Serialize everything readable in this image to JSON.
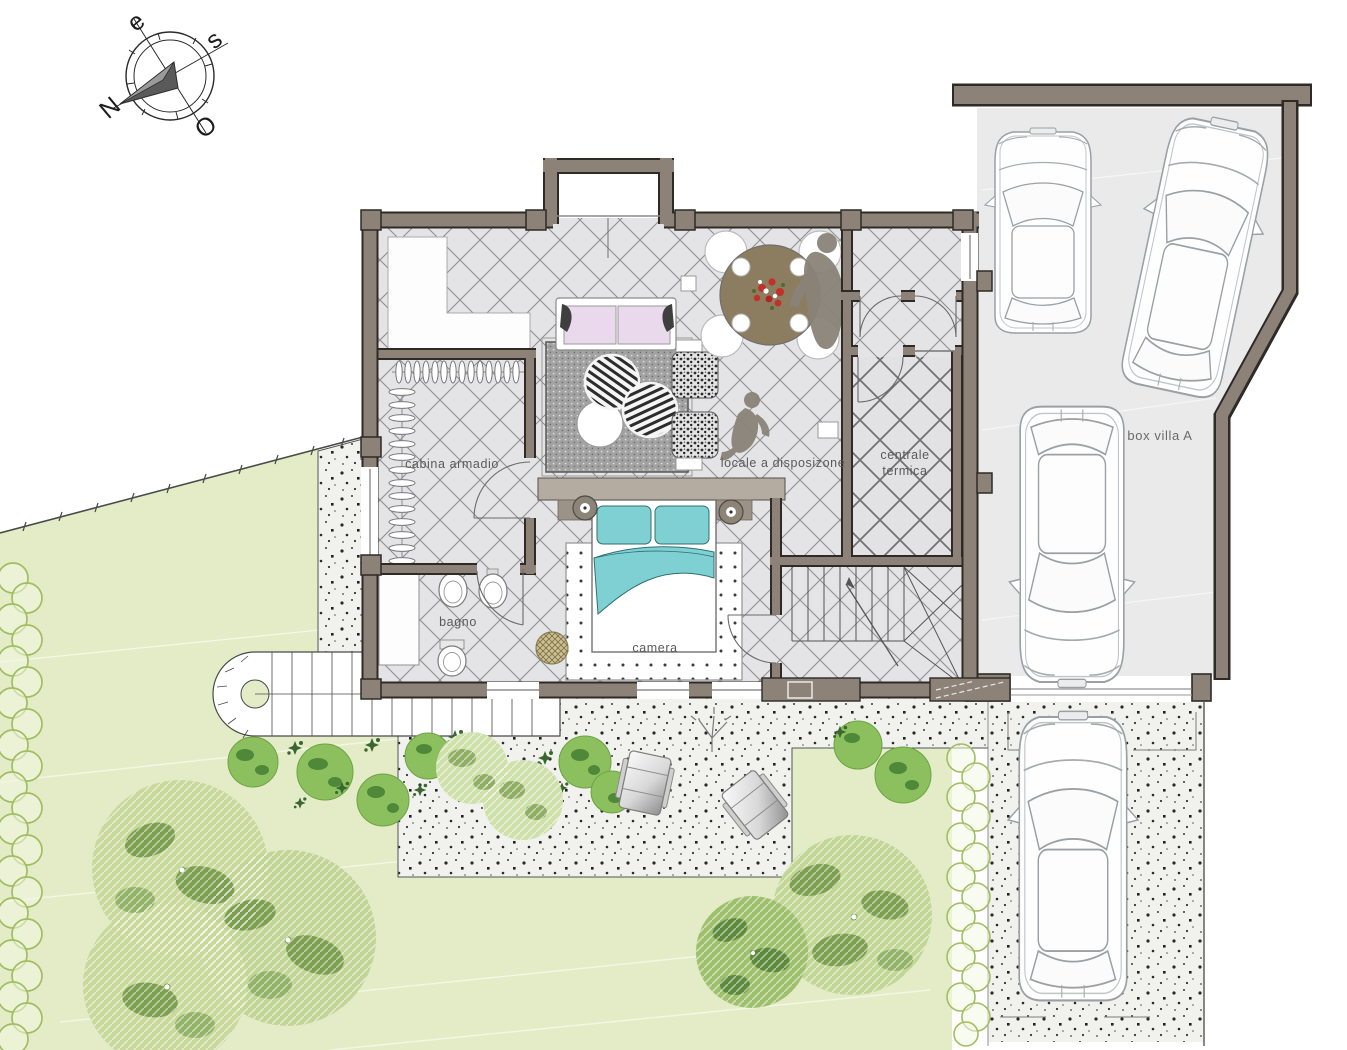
{
  "plan": {
    "title": "villa ground floor plan",
    "compass": {
      "north": "N",
      "east": "e",
      "south": "s",
      "west": "O"
    },
    "rooms": {
      "cabina_armadio": "cabina armadio",
      "bagno": "bagno",
      "camera": "camera",
      "locale": "locale a disposizone",
      "centrale_line1": "centrale",
      "centrale_line2": "termica",
      "box_villa": "box villa A"
    },
    "colors": {
      "wall": "#8d8278",
      "wall_outline": "#2e2a26",
      "floor_tile": "#e4e4e6",
      "garage_floor": "#eaeaea",
      "lawn": "#e3ecc6",
      "tree_light": "#c8d99b",
      "tree_dark": "#7d9f50",
      "hedge": "#a2bd62",
      "bed_accent": "#7fd0d2",
      "sofa_accent": "#ead9ec",
      "table_wood": "#8c7c60",
      "flower_red": "#c2302a",
      "stipple_bg": "#f1f1ee"
    }
  }
}
